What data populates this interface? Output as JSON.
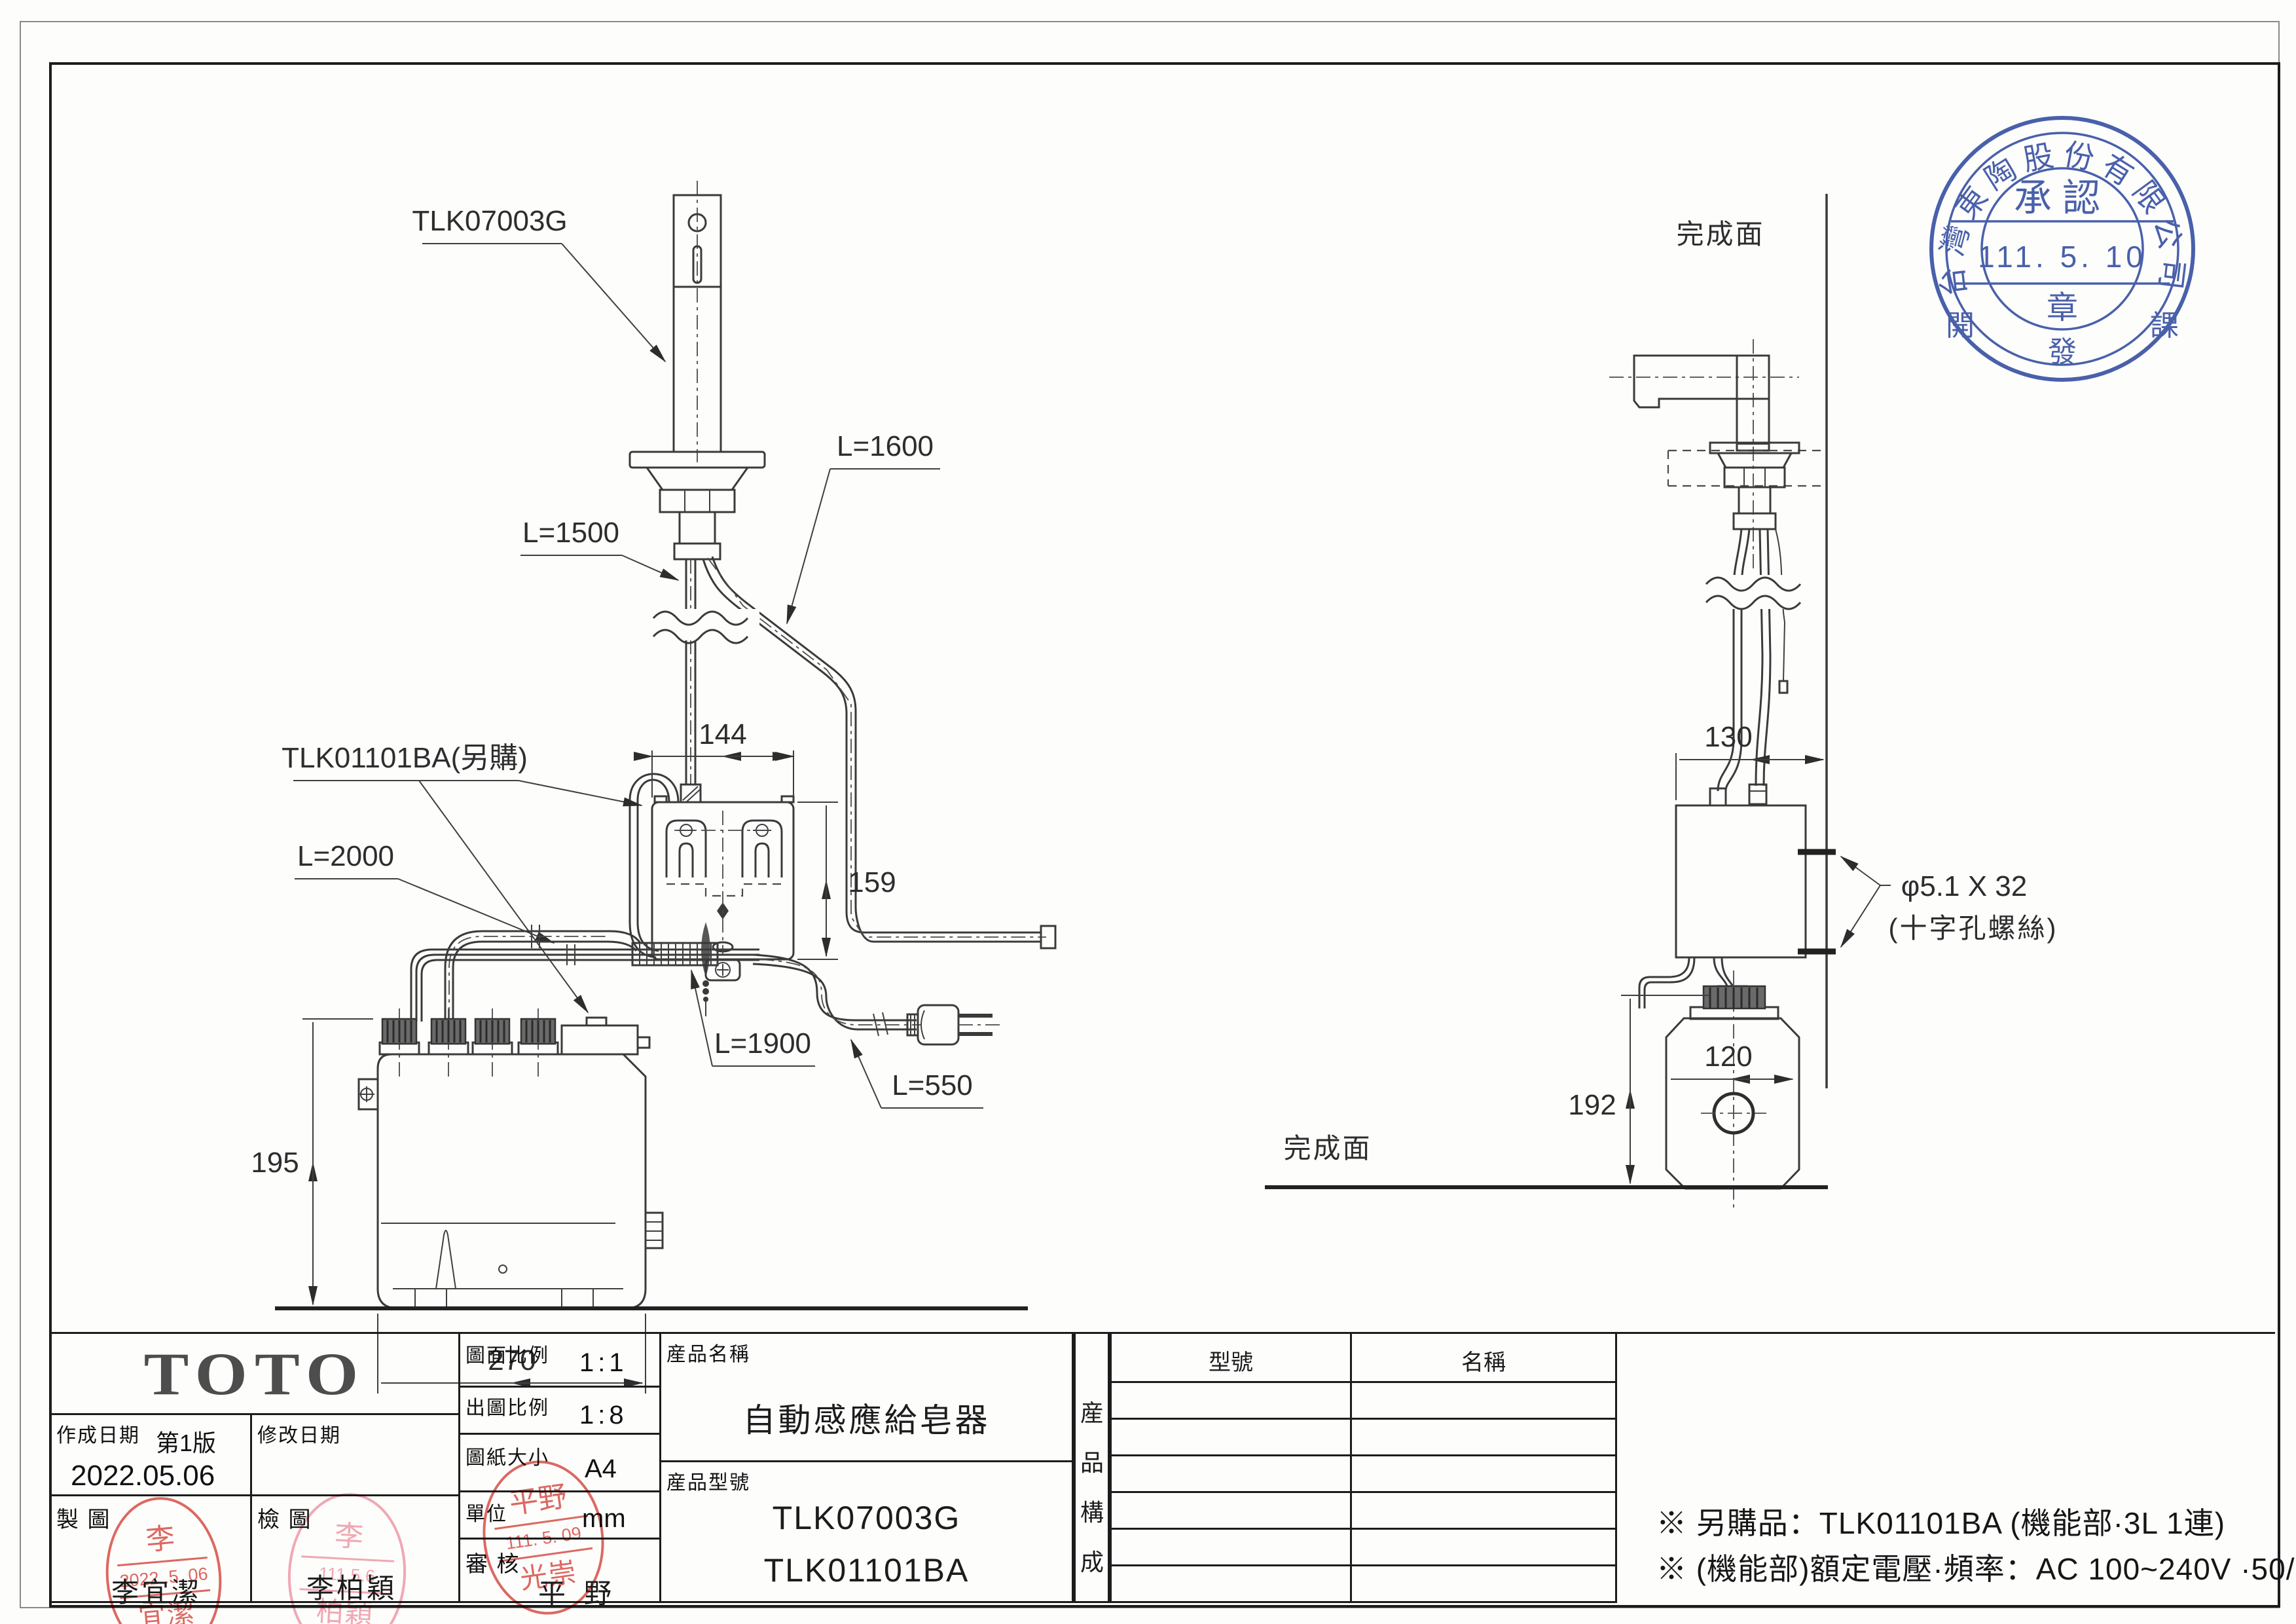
{
  "drawing": {
    "front_view": {
      "spout_label": "TLK07003G",
      "controller_label": "TLK01101BA(另購)",
      "cable_1500": "L=1500",
      "cable_1600": "L=1600",
      "hose_2000": "L=2000",
      "bundle_1900": "L=1900",
      "cord_550": "L=550",
      "dim_box_width": "144",
      "dim_box_height": "159",
      "dim_tank_height": "195",
      "dim_tank_width": "270"
    },
    "side_view": {
      "finished_surface_top": "完成面",
      "finished_surface_bottom": "完成面",
      "dim_box_width": "130",
      "dim_tank_width": "120",
      "dim_tank_height": "192",
      "screw_note_line1": "φ5.1 X 32",
      "screw_note_line2": "(十字孔螺絲)"
    },
    "approval_stamp": {
      "company_arc": "台灣東陶股份有限公司",
      "title": "承認",
      "date": "111. 5. 10",
      "seal_char": "章",
      "dept_left": "開",
      "dept_center": "發",
      "dept_right": "課",
      "color": "#3a53a4"
    }
  },
  "title_block": {
    "logo": "TOTO",
    "created_label": "作成日期",
    "version": "第1版",
    "created_date": "2022.05.06",
    "modified_label": "修改日期",
    "drafted_label": "製  圖",
    "checked_label": "檢  圖",
    "review_label": "審  核",
    "scale_label": "圖面比例",
    "scale_value": "1:1",
    "plot_scale_label": "出圖比例",
    "plot_scale_value": "1:8",
    "paper_label": "圖紙大小",
    "paper_value": "A4",
    "unit_label": "單位",
    "unit_value": "mm",
    "product_name_label": "産品名稱",
    "product_name": "自動感應給皂器",
    "product_model_label": "産品型號",
    "model_1": "TLK07003G",
    "model_2": "TLK01101BA",
    "composition_char1": "産",
    "composition_char2": "品",
    "composition_char3": "構",
    "composition_char4": "成",
    "table_col_model": "型號",
    "table_col_name": "名稱",
    "drafter_name": "李宜潔",
    "checker_name": "李柏穎",
    "approver_name": "平野",
    "stamps": {
      "draft": {
        "top": "李",
        "date": "2022 .5. 06",
        "bottom": "宜潔",
        "color": "#d94f46"
      },
      "check": {
        "top": "李",
        "date": "111.5.6",
        "bottom": "柏穎",
        "color": "#f09aa8"
      },
      "review": {
        "top": "平野",
        "date": "111. 5. 09",
        "bottom": "光崇",
        "color": "#d94f46"
      }
    }
  },
  "notes": {
    "line1": "※ 另購品：TLK01101BA (機能部·3L 1連)",
    "line2": "※ (機能部)額定電壓·頻率：AC 100~240V ·50/60Hz"
  }
}
